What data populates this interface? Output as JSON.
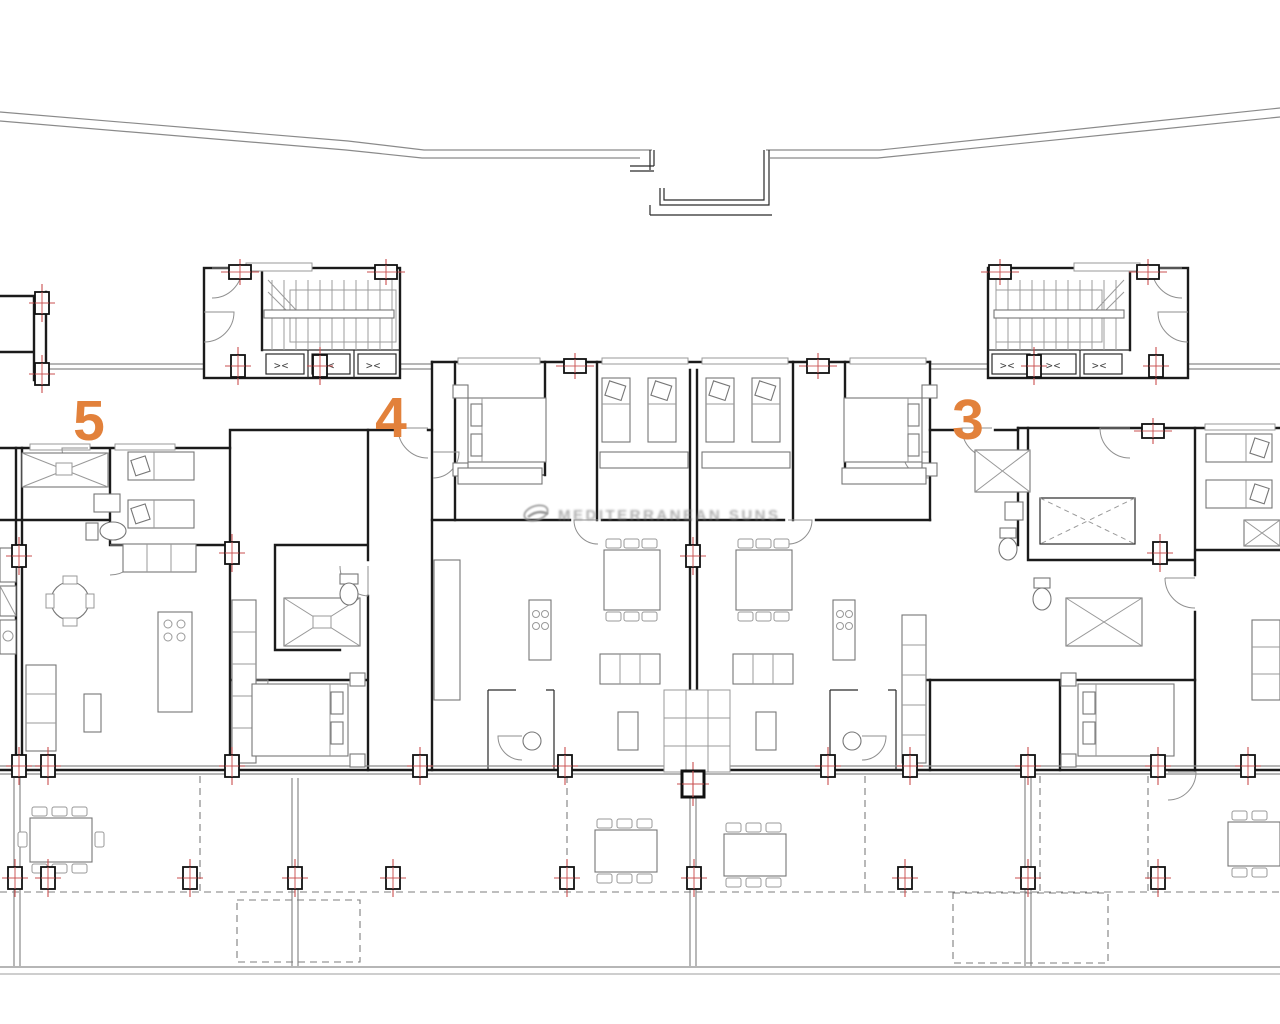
{
  "plan": {
    "unit_labels": [
      {
        "label": "5"
      },
      {
        "label": "4"
      },
      {
        "label": "3"
      }
    ],
    "lift_symbol": "><",
    "watermark": {
      "text": "MEDITERRANEAN SUNS"
    },
    "colors": {
      "unit_label_orange": "#E2813B",
      "column_marker_red": "#C94F4F",
      "wall": "#1B1B1B",
      "light_line": "#8A8A8A"
    }
  }
}
